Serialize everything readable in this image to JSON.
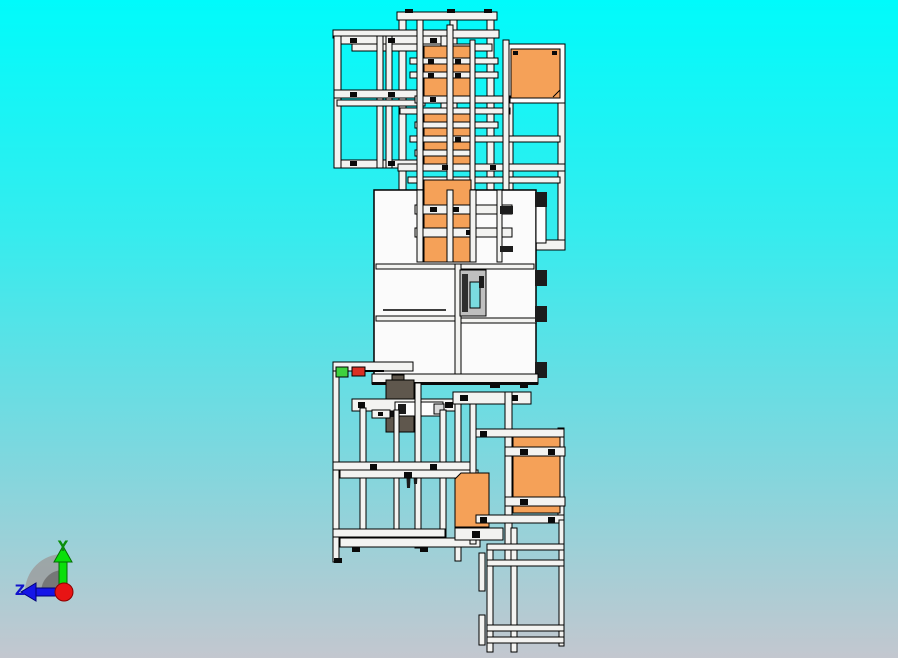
{
  "app": {
    "type": "cad-3d-viewport",
    "description": "Side view of machine frame assembly"
  },
  "viewport": {
    "background_top_color": "#00FBFB",
    "background_mid_color": "#6FDCE2",
    "background_bottom_color": "#C3C7CF"
  },
  "model": {
    "frame_color": "#F3F3F1",
    "outline_color": "#000000",
    "panel_orange_color": "#F5A158",
    "cabinet_color": "#FBFBFB",
    "control_box_color": "#5F574D",
    "indicator_green_color": "#3ED23E",
    "indicator_red_color": "#D93024",
    "mechanism_teal_color": "#7ADCE0"
  },
  "triad": {
    "y_label": "Y",
    "z_label": "Z",
    "y_axis_color": "#0ADF0A",
    "y_label_color": "#0A8E0A",
    "z_axis_color": "#1515E8",
    "z_label_color": "#1212CC",
    "origin_color": "#E81414",
    "shadow_color": "#9B9B9B"
  }
}
